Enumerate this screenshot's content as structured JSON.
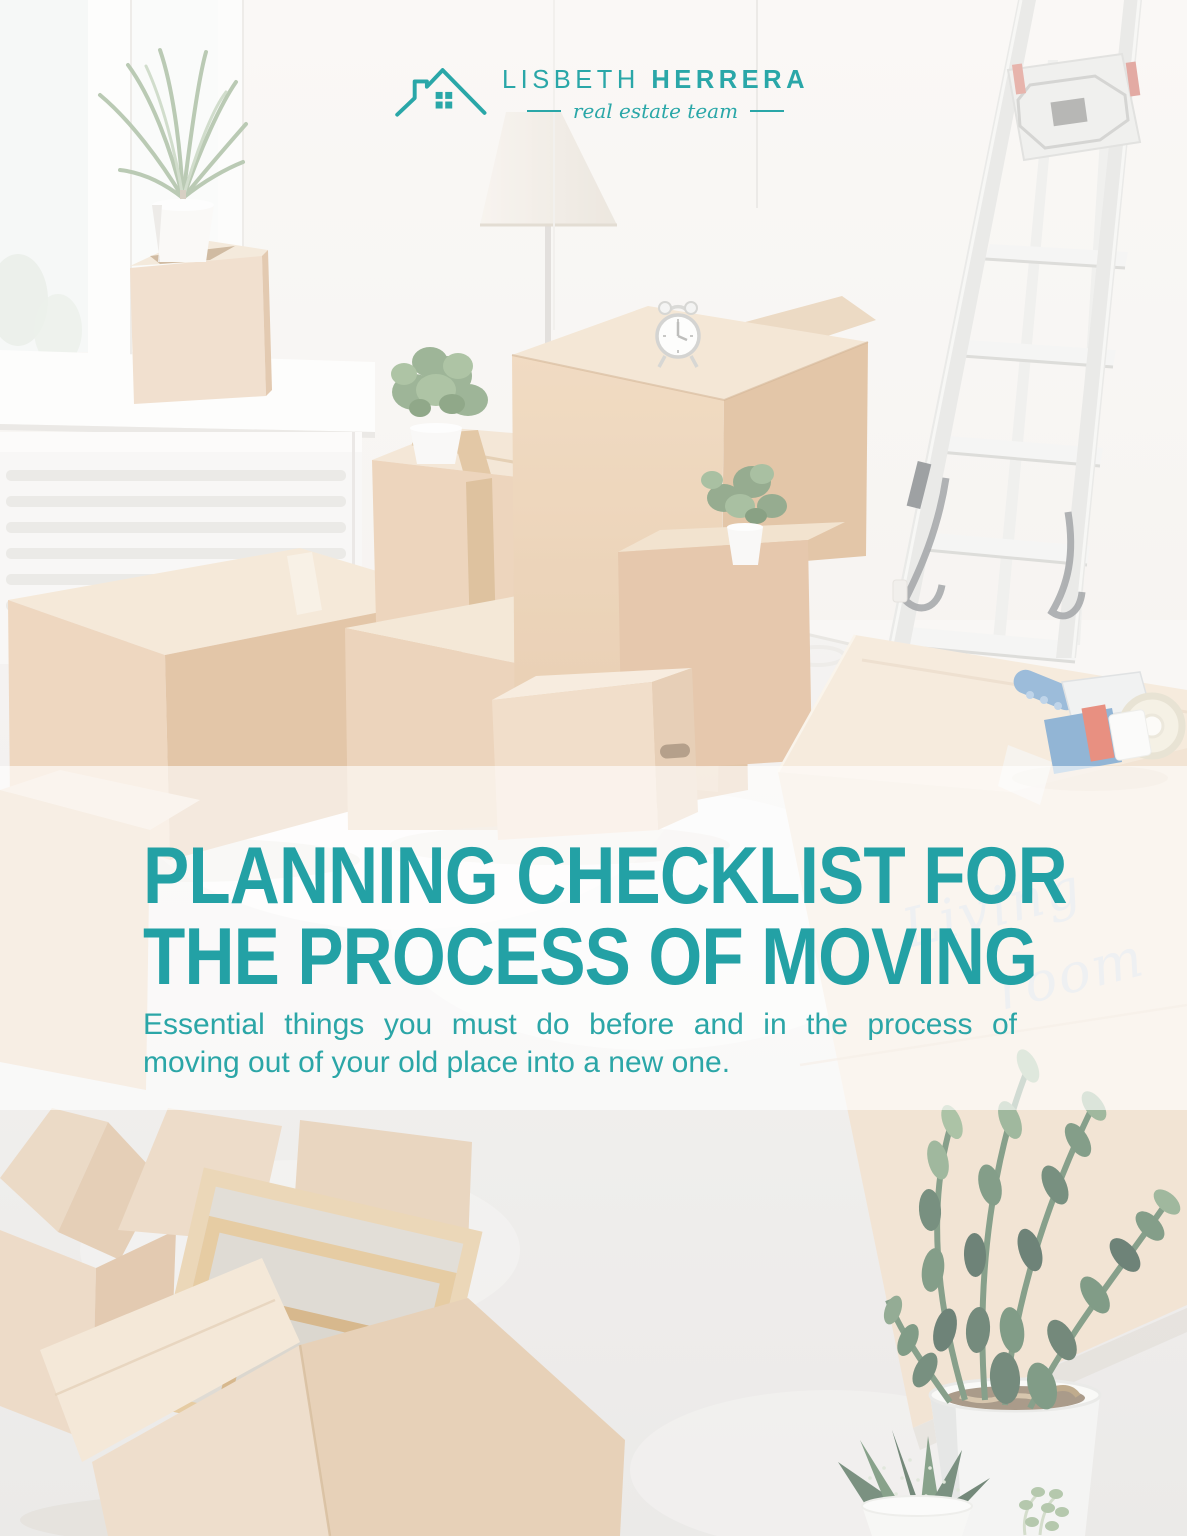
{
  "page": {
    "width": 1187,
    "height": 1536,
    "kind": "real-estate flyer cover"
  },
  "brand": {
    "name_first": "LISBETH",
    "name_last": "HERRERA",
    "tagline": "real estate team",
    "accent_color": "#2aa7a8",
    "logo_icon": "house-icon"
  },
  "hero": {
    "title_line1": "PLANNING CHECKLIST FOR",
    "title_line2": "THE PROCESS OF MOVING",
    "subtitle_line1": "Essential things you must do before and in the process of",
    "subtitle_line2": "moving out of your old place into a new one.",
    "title_color": "#23a1a5",
    "subtitle_color": "#2ba6a7"
  },
  "photo": {
    "overlay_band_opacity": 0.62,
    "handwriting_line1": "Living",
    "handwriting_line2": "room",
    "handwriting_color": "#c3c9d0",
    "objects": [
      "window",
      "windowsill-plant",
      "cardboard-boxes",
      "floor-lamp",
      "step-ladder",
      "alarm-clock",
      "small-potted-plants",
      "radiator",
      "tape-dispenser",
      "box-marked-living-room",
      "open-box-with-picture-frames",
      "open-empty-box",
      "zz-plant",
      "aloe-succulent",
      "jade-sprig"
    ]
  }
}
